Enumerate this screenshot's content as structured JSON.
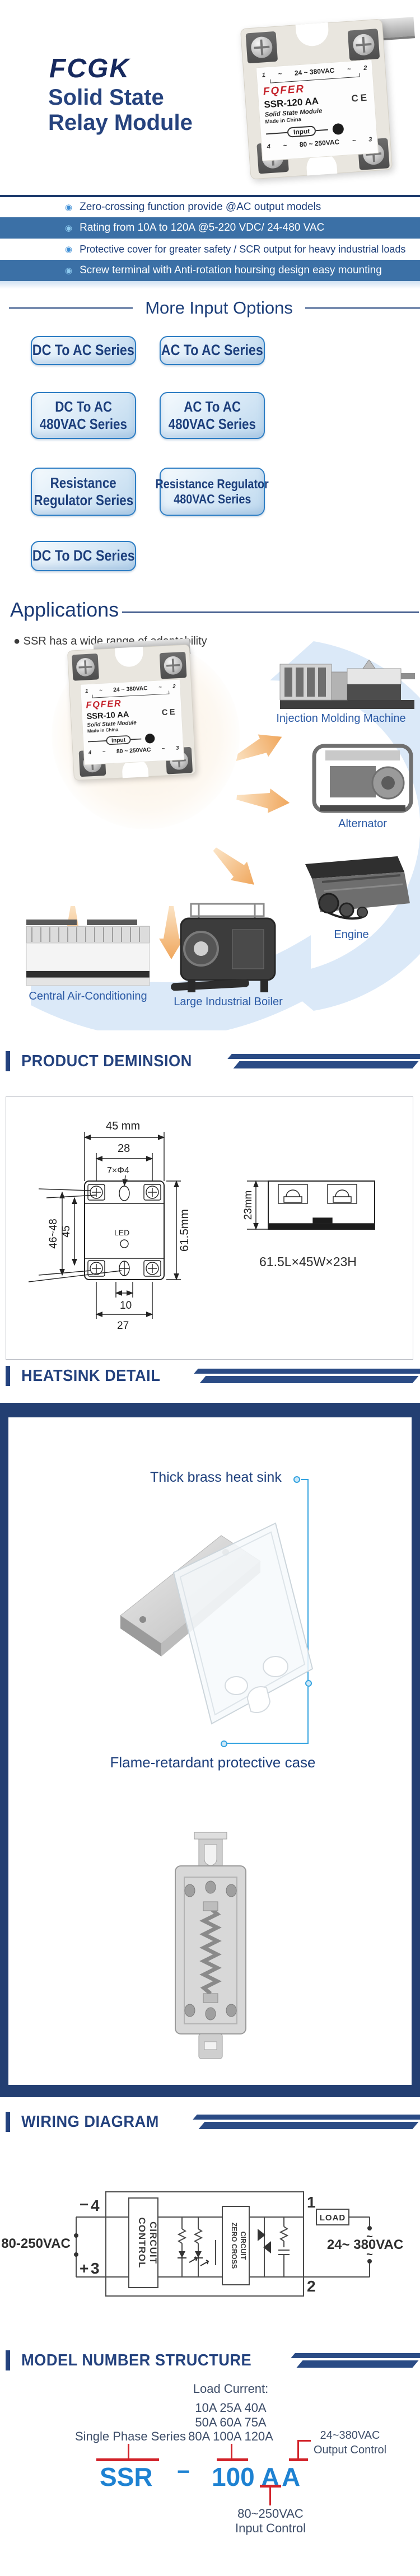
{
  "colors": {
    "accent_navy": "#24427E",
    "bar_blue": "#3B70A6",
    "code_blue": "#1E82D2",
    "red": "#D2232A",
    "callout_blue": "#35A3E0",
    "arrow_orange": "#F2A95E",
    "app_label_blue": "#2B5AA5"
  },
  "brand": {
    "logo": "FCGK",
    "title1": "Solid State",
    "title2": "Relay Module"
  },
  "hero": {
    "relay": {
      "t1": "1",
      "t2": "2",
      "t3": "3",
      "t4": "4",
      "tilde": "~",
      "top_voltage": "24 ~ 380VAC",
      "brand": "FQFER",
      "model": "SSR-120 AA",
      "ce": "CE",
      "type": "Solid State Module",
      "origin": "Made in China",
      "input": "Input",
      "bottom_voltage": "80 ~ 250VAC"
    }
  },
  "features": {
    "bullet": "◉",
    "items": [
      "Zero-crossing function provide @AC output models",
      "Rating from 10A to 120A @5-220 VDC/ 24-480 VAC",
      "Protective cover for greater safety  / SCR output for heavy industrial loads",
      "Screw terminal with  Anti-rotation hoursing design easy mounting"
    ]
  },
  "options": {
    "heading": "More Input Options",
    "buttons": [
      {
        "line1": "DC To AC Series",
        "line2": ""
      },
      {
        "line1": "AC To AC Series",
        "line2": ""
      },
      {
        "line1": "DC To AC",
        "line2": "480VAC Series"
      },
      {
        "line1": "AC To AC",
        "line2": "480VAC Series"
      },
      {
        "line1": "Resistance",
        "line2": "Regulator Series"
      },
      {
        "line1": "Resistance Regulator",
        "line2": "480VAC Series"
      },
      {
        "line1": "DC To DC Series",
        "line2": ""
      }
    ]
  },
  "apps": {
    "heading": "Applications",
    "bullet": "●",
    "note": "SSR has a wide range of adaptability",
    "relay": {
      "t1": "1",
      "t2": "2",
      "t3": "3",
      "t4": "4",
      "tilde": "~",
      "top_voltage": "24 ~ 380VAC",
      "brand": "FQFER",
      "model": "SSR-10 AA",
      "ce": "CE",
      "type": "Solid State Module",
      "origin": "Made in China",
      "input": "Input",
      "bottom_voltage": "80 ~ 250VAC"
    },
    "labels": {
      "injection": "Injection Molding Machine",
      "alternator": "Alternator",
      "engine": "Engine",
      "ac": "Central Air-Conditioning",
      "boiler": "Large Industrial Boiler"
    }
  },
  "dim": {
    "header": "PRODUCT DEMINSION",
    "w": "45 mm",
    "w_inner": "28",
    "hole": "7×Φ4",
    "h_range": "46~48",
    "h_inner": "45",
    "led": "LED",
    "h_total": "61.5mm",
    "b_inner": "10",
    "b_outer": "27",
    "depth": "23mm",
    "summary": "61.5L×45W×23H"
  },
  "hs": {
    "header": "HEATSINK DETAIL",
    "top_label": "Thick brass heat sink",
    "bottom_label": "Flame-retardant protective case"
  },
  "wiring": {
    "header": "WIRING DIAGRAM",
    "minus": "−",
    "t4": "4",
    "plus": "+",
    "t3": "3",
    "t1": "1",
    "t2": "2",
    "tilde": "~",
    "left_v": "80-250VAC",
    "control1": "CONTROL",
    "control2": "CIRCUIT",
    "zc1": "ZERO CROSS",
    "zc2": "CIRCUIT",
    "load": "LOAD",
    "right_v": "24~ 380VAC"
  },
  "mn": {
    "header": "MODEL NUMBER STRUCTURE",
    "load_title": "Load Current:",
    "amps1": "10A 25A 40A",
    "amps2": "50A 60A 75A",
    "amps3": "80A 100A 120A",
    "series": "Single Phase Series",
    "out1": "24~380VAC",
    "out2": "Output Control",
    "code": {
      "p1": "SSR",
      "dash": "−",
      "p2": "100",
      "p3": "A",
      "p4": "A"
    },
    "in1": "80~250VAC",
    "in2": "Input Control"
  }
}
